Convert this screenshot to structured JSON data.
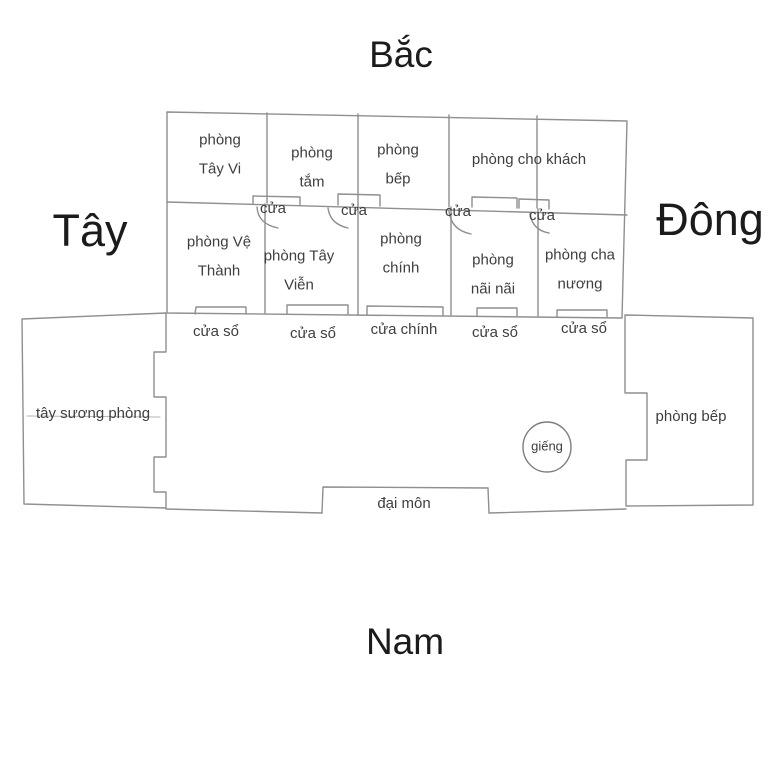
{
  "compass": {
    "north": "Bắc",
    "south": "Nam",
    "west": "Tây",
    "east": "Đông"
  },
  "north_building": {
    "row1": [
      {
        "label": "phòng Tây Vi"
      },
      {
        "label": "phòng tắm"
      },
      {
        "label": "phòng bếp"
      },
      {
        "label": "phòng cho khách"
      }
    ],
    "row2": [
      {
        "label": "phòng Vệ Thành"
      },
      {
        "label": "phòng Tây Viễn"
      },
      {
        "label": "phòng chính"
      },
      {
        "label": "phòng nãi nãi"
      },
      {
        "label": "phòng cha nương"
      }
    ],
    "interior_doors": [
      {
        "label": "cửa"
      },
      {
        "label": "cửa"
      },
      {
        "label": "cửa"
      },
      {
        "label": "cửa"
      }
    ],
    "front_openings": [
      {
        "label": "cửa sổ"
      },
      {
        "label": "cửa sổ"
      },
      {
        "label": "cửa chính"
      },
      {
        "label": "cửa sổ"
      },
      {
        "label": "cửa sổ"
      }
    ]
  },
  "west_wing": {
    "label": "tây sương phòng"
  },
  "east_wing": {
    "label": "phòng bếp"
  },
  "courtyard": {
    "well_label": "giếng",
    "gate_label": "đại môn"
  },
  "colors": {
    "background": "#ffffff",
    "wall_line": "#8f8f8f",
    "faint_line": "#b5b5b5",
    "room_text": "#3e3e3e",
    "compass_text": "#1b1b1b"
  }
}
